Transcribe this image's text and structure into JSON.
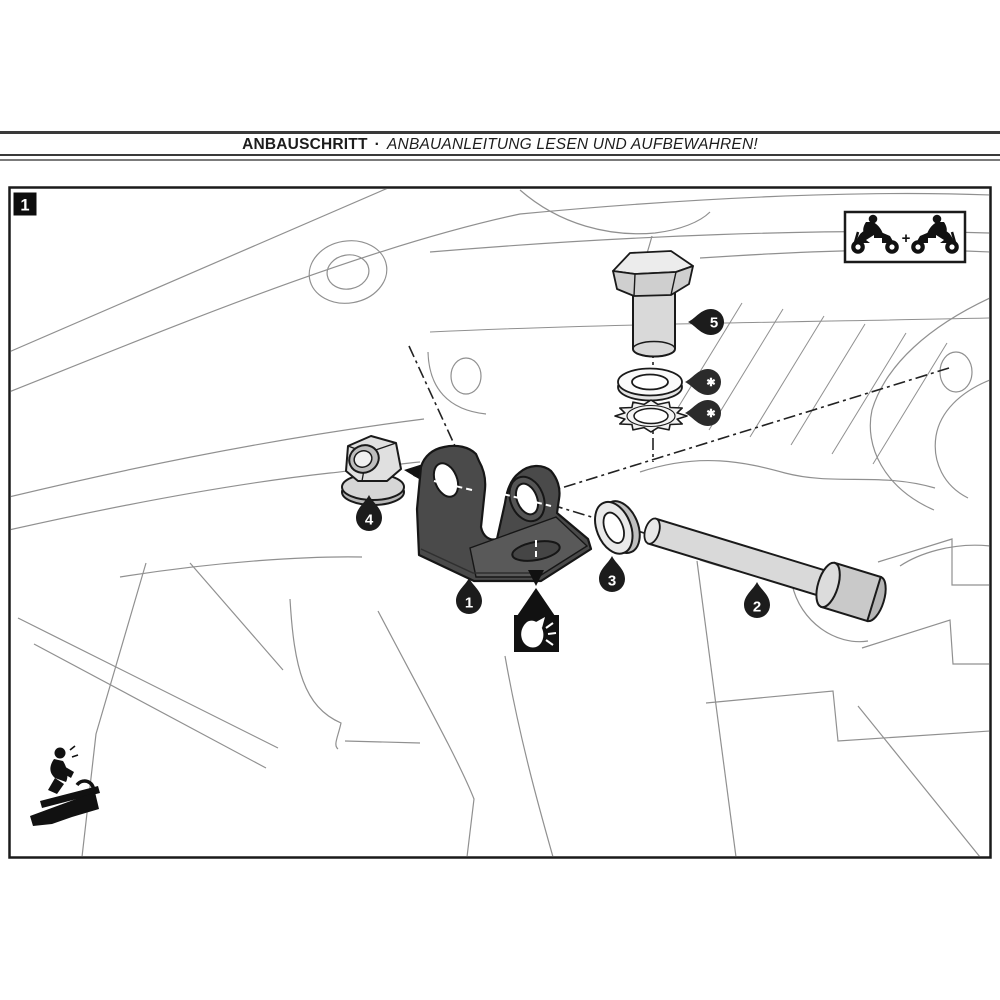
{
  "header": {
    "title_bold": "ANBAUSCHRITT",
    "separator": "·",
    "title_italic": "ANBAUANLEITUNG LESEN UND AUFBEWAHREN!"
  },
  "figure": {
    "step_badge": "1",
    "plus_sign": "+",
    "labels": {
      "bracket": "1",
      "spacer_sleeve": "2",
      "washer": "3",
      "flange_nut": "4",
      "hex_bolt": "5",
      "flat_washer_note": "✱",
      "lock_washer_note": "✱"
    },
    "icons": {
      "rider_pair_box": "motorcycle-riders-pair",
      "grease_point": "grease-applicator",
      "workstand": "rider-on-workstand"
    }
  },
  "colors": {
    "outline": "#1a1a1a",
    "part_fill": "#d9d9d9",
    "bracket_fill": "#4a4a4a",
    "background_line": "#909090",
    "label_fill": "#1c1c1c"
  }
}
